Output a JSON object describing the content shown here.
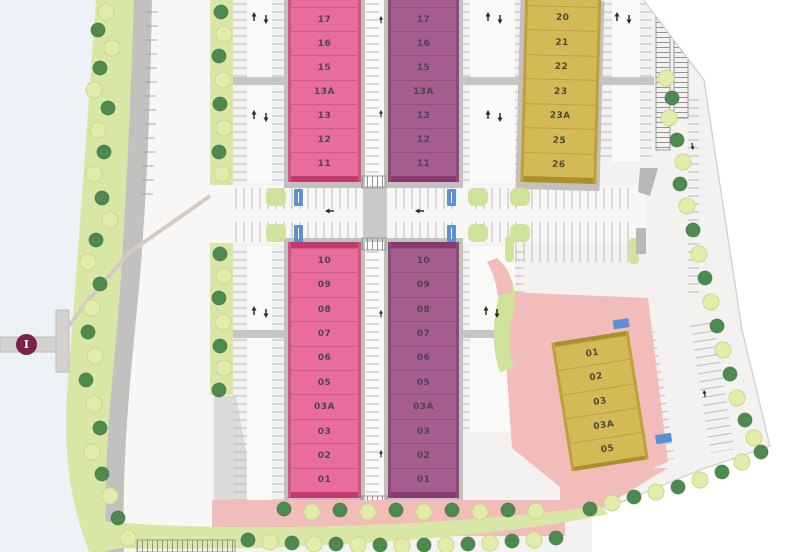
{
  "plan": {
    "marker": {
      "label": "I"
    },
    "colors": {
      "pink_block": "#e96d9c",
      "purple_block": "#a55d8d",
      "yellow_block": "#d3ba57",
      "plaza_pink": "#f2bcba",
      "landscape_green": "#d8e7a6",
      "tree_dark": "#4d8a4f",
      "tree_light": "#e4ecab",
      "accessible_bay_blue": "#5c90d2",
      "marker_maroon": "#7c2146"
    },
    "blocks": {
      "north_west": {
        "color": "#e96d9c",
        "units": [
          "18",
          "17",
          "16",
          "15",
          "13A",
          "13",
          "12",
          "11"
        ]
      },
      "north_mid": {
        "color": "#a55d8d",
        "units": [
          "18",
          "17",
          "16",
          "15",
          "13A",
          "13",
          "12",
          "11"
        ]
      },
      "south_west": {
        "color": "#e96d9c",
        "units": [
          "10",
          "09",
          "08",
          "07",
          "06",
          "05",
          "03A",
          "03",
          "02",
          "01"
        ]
      },
      "south_mid": {
        "color": "#a55d8d",
        "units": [
          "10",
          "09",
          "08",
          "07",
          "06",
          "05",
          "03A",
          "03",
          "02",
          "01"
        ]
      },
      "north_east": {
        "color": "#d3ba57",
        "units": [
          "19",
          "20",
          "21",
          "22",
          "23",
          "23A",
          "25",
          "26"
        ]
      },
      "south_east": {
        "color": "#d3ba57",
        "units": [
          "01",
          "02",
          "03",
          "03A",
          "05"
        ]
      }
    }
  }
}
